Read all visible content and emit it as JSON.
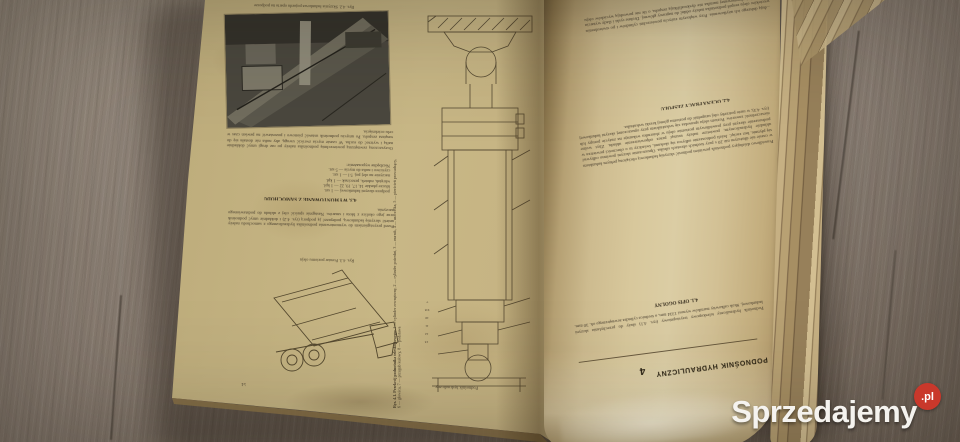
{
  "colors": {
    "wood": "#877b70",
    "paper_left": "#c8b786",
    "paper_right": "#d8c89c",
    "ink": "#43392b",
    "watermark_badge": "#c9382b",
    "watermark_text": "#f5f3ef"
  },
  "watermark": {
    "brand": "Sprzedajemy",
    "badge": ".pl"
  },
  "left_page": {
    "page_number": "51",
    "running_title": "Podnośnik hydrauliczny",
    "photo_caption": "Rys. 4.2. Skrzynia ładunkowa pojazdu oparta na podporze",
    "par_a": "Oczyszczoną zewnętrzną powierzchnię podnośnika należy po raz drugi umyć dokładnie naftą i wytrzeć do sucha. W czasie mycia zwrócić uwagę, aby nafta nie dostała się do wnętrza zespołu. Po umyciu podnośnik ustawić pionowo i pozostawić na pewien czas w celu ocieknięcia.",
    "tools_intro": "Niezbędne wyposażenie:",
    "tools": [
      "podpora skrzyni ładunkowej — 1 szt.",
      "klucze płaskie 14, 17, 19, 22 — 1 kpl.",
      "wkrętak, młotek, przecinak — 1 kpl.",
      "naczynie na olej poj. 5 l — 1 szt.",
      "czyściwo i nafta do mycia — 5 szt."
    ],
    "section_heading": "4.3. WYMONTOWANIE Z SAMOCHODU",
    "par_b": "Przed przystąpieniem do wymontowania podnośnika hydraulicznego z samochodu należy unieść skrzynię ładunkową, podeprzeć ją podporą (rys. 4.2) i dokładnie umyć podnośnik oraz jego okolice z błota i smarów. Następnie spuścić olej z układu do podstawionego naczynia.",
    "truck_caption": "Rys. 4.3. Pomiar poziomu oleju",
    "cross_caption_title": "Rys. 4.1. Przekrój podnośnika teleskopowego:",
    "cross_caption_legend": "1 — cylinder zewnętrzny, 2 — cylinder pośredni, 3 — nurnik, 4 — uszczelka, 5 — pierścień prowadzący, 6 — głowica, 7 — przegub kulowy, 8 — podstawa",
    "cross_numbers": "13 12 11 10 9 8 7"
  },
  "right_page": {
    "par_top": "...dują dalszego ich użytkowania. Przy większym zużyciu powierzchni cylindrów i po stwierdzeniu wycieków oleju zespół podnośnika należy oddać do naprawy głównej. Drobne ryski i ślady wytarcia powierzchni chromowanej nurnika nie dyskwalifikują zespołu, o ile nie powodują wycieków oleju podczas pracy.",
    "heading_42": "4.2. OCENA PRACY ZESPOŁU",
    "par_mid": "Prawidłowo działający podnośnik powinien podnosić skrzynię ładunkową obciążoną pełnym ładunkiem w czasie nie dłuższym niż 20 s przy średnich obrotach silnika. Opuszczanie skrzyni powinno odbywać się płynnie, bez zacięć. Jeżeli podnoszenie odbywa się skokami, świadczy to o obecności powietrza w układzie hydraulicznym; powietrze należy usunąć przez odpowietrzenie układu. Zbyt wolne podnoszenie skrzyni przy prawidłowym poziomie oleju w zbiorniku wskazuje na zużycie pompy lub nieszczelność zaworów. Poziom oleju sprawdza się wskaźnikiem przy opuszczonej skrzyni ładunkowej (rys. 4.3); w razie potrzeby olej uzupełnić do poziomu górnej kreski wskaźnika.",
    "heading_41": "4.1. OPIS OGÓLNY",
    "par_bottom": "Podnośnik hydrauliczny teleskopowy trzystopniowy (rys. 4.1) służy do przechylania skrzyni ładunkowej. Skok całkowity nurników wynosi 1334 mm, a średnica cylindra zewnętrznego ok. 30 mm.",
    "chapter_number": "4",
    "chapter_title": "PODNOŚNIK HYDRAULICZNY"
  }
}
